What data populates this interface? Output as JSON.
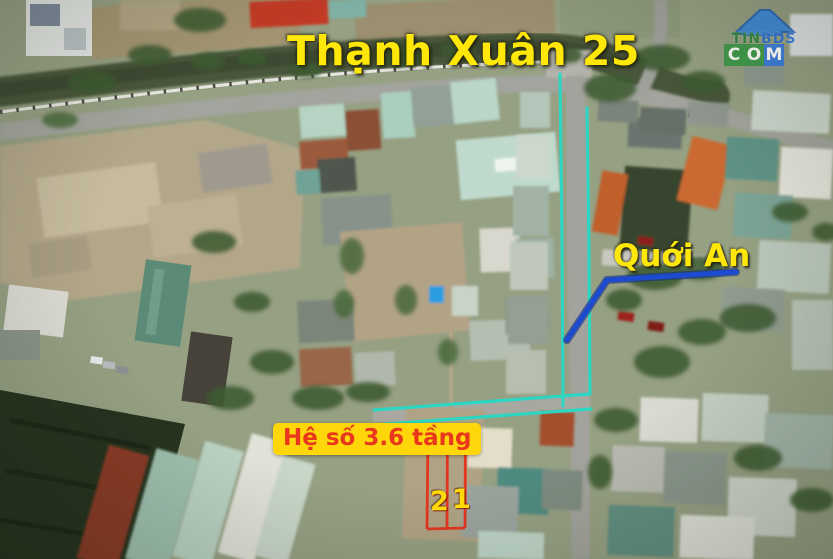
{
  "overlay": {
    "title": "Thạnh Xuân 25",
    "area_label": "Quới An",
    "zoning_label": "Hệ số 3.6 tầng",
    "plots": [
      {
        "number": "2"
      },
      {
        "number": "1"
      }
    ],
    "colors": {
      "highlight_cyan": "#28d9c6",
      "arrow_blue": "#1d4bd0",
      "arrow_blue_dark": "#14307e",
      "plot_red": "#e5301b",
      "title_yellow": "#ffe70a",
      "zoning_bg": "#ffd60a",
      "zoning_text": "#e8371c",
      "number_yellow": "#ffd908"
    }
  },
  "watermark": {
    "name_green": "TIN",
    "name_blue": "BDS",
    "com_letters": [
      "C",
      "O",
      "M"
    ],
    "house_color": "#2278d8"
  }
}
